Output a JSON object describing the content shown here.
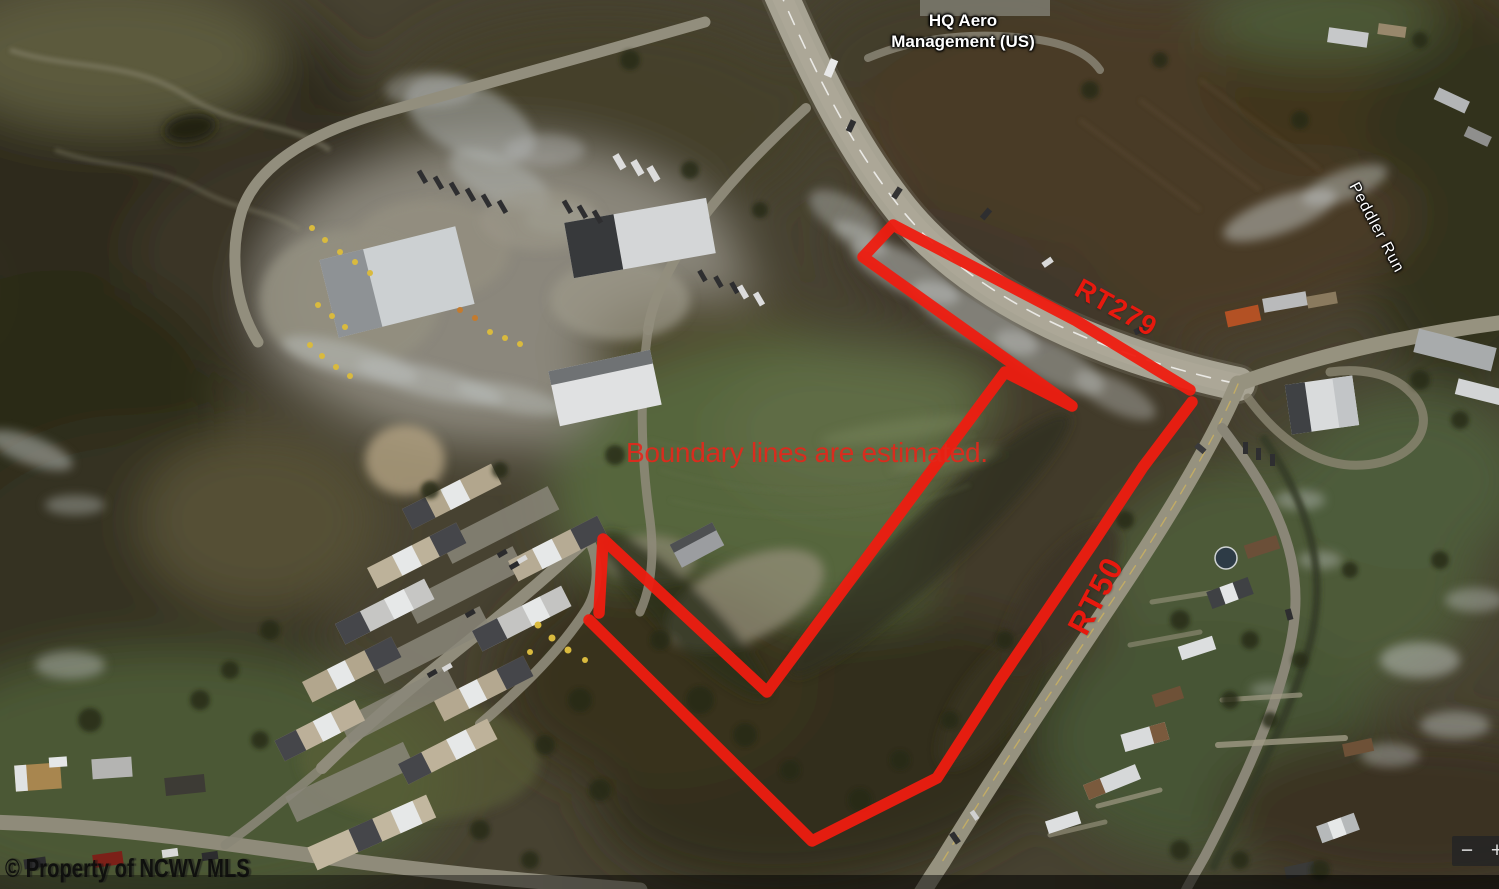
{
  "map": {
    "labels": {
      "poi_line1": "HQ Aero",
      "poi_line2": "Management (US)",
      "waterway": "Peddler Run"
    },
    "road_labels": {
      "rt279": "RT279",
      "rt50": "RT50"
    }
  },
  "annotations": {
    "note": "Boundary lines are estimated.",
    "color": "#ee1c10",
    "boundary_paths": {
      "inner": "M 599 613 L 603 539 L 767 692 L 1005 372 L 1072 406 L 863 257 L 893 225 L 1075 320 L 1190 390",
      "outer": "M 589 620 L 812 841 L 937 778 L 1000 680 L 1093 543 L 1143 467 L 1192 402"
    }
  },
  "watermark": "© Property of NCWV MLS",
  "zoom_control": {
    "minus": "−",
    "plus": "+"
  },
  "colors": {
    "annotation_red": "#ee1c10",
    "label_white": "#ffffff"
  }
}
